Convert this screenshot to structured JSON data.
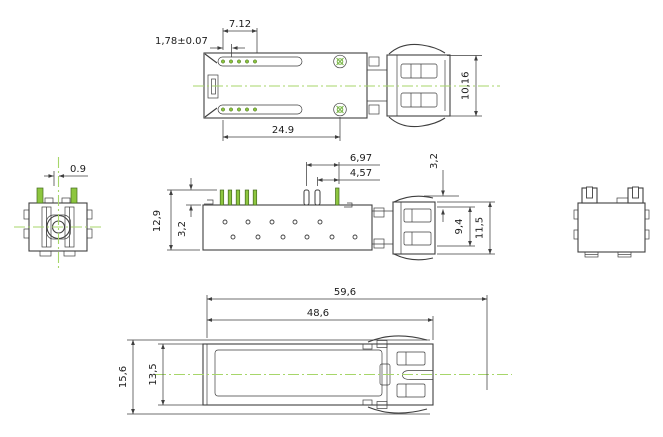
{
  "drawing_type": "mechanical-dimension-drawing",
  "colors": {
    "line": "#3f3f3f",
    "pin_green": "#8dc63f",
    "centerline_green": "#a7d66a"
  },
  "views": {
    "top": {
      "dims": {
        "pin_group": "7.12",
        "pin_pitch": "1,78±0.07",
        "slot_span": "24.9",
        "rear_height": "10,16"
      }
    },
    "side": {
      "dims": {
        "pin_span_outer": "6,97",
        "pin_span_inner": "4,57",
        "height_total": "12,9",
        "pin_height": "3,2",
        "rear_offset": "3,2",
        "rear_inner_height": "9,4",
        "rear_total_height": "11,5"
      }
    },
    "bottom": {
      "dims": {
        "length_total": "59,6",
        "length_body": "48,6",
        "width_total": "15,6",
        "width_body": "13,5"
      }
    },
    "front": {
      "dims": {
        "pin_offset": "0.9"
      }
    }
  }
}
